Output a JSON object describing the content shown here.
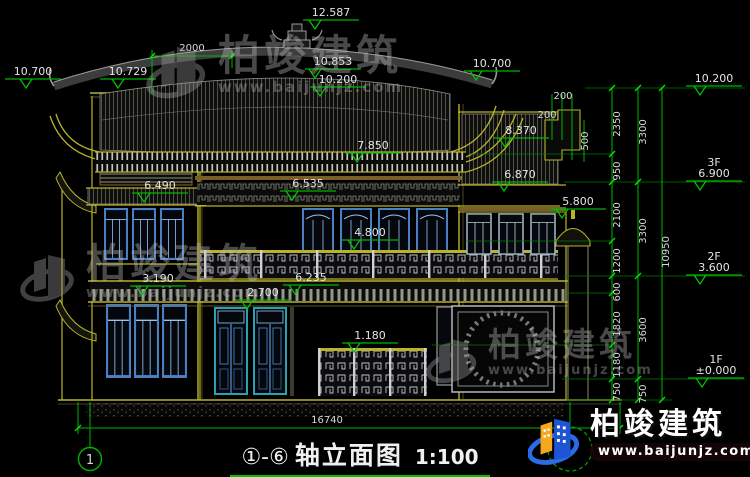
{
  "title": {
    "axes": "①-⑥",
    "name": "轴立面图",
    "scale": "1:100"
  },
  "axis_bubbles": {
    "left": "1"
  },
  "watermark": {
    "brand": "柏竣建筑",
    "url": "www.baijunjz.com"
  },
  "logo": {
    "brand": "柏竣建筑",
    "url": "www.baijunjz.com"
  },
  "colors": {
    "background": "#000000",
    "dim_green": "#00b400",
    "outline_yellow": "#b9b32a",
    "window_blue": "#4a7fc1",
    "text": "#e4e4e4"
  },
  "elevations": {
    "ridge": "12.587",
    "left_eave_outer": "10.700",
    "left_eave_inner": "10.729",
    "roof_upper": "10.853",
    "roof_lower": "10.200",
    "right_eave": "10.700",
    "right_parapet": "10.200",
    "wing_parapet": "8.370",
    "wing_band": "6.870",
    "wing_beam": "5.800",
    "f3_rail": "7.850",
    "f3_beam": "6.535",
    "f2_rail": "4.800",
    "f2_beam": "6.235",
    "door_top": "2.700",
    "f1_rail": "1.180",
    "tower_upper": "6.490",
    "tower_lower": "3.190",
    "floor3_label": "3F",
    "floor3": "6.900",
    "floor2_label": "2F",
    "floor2": "3.600",
    "floor1_label": "1F",
    "floor1": "±0.000"
  },
  "dimensions": {
    "top_span": "2000",
    "total_width": "16740",
    "parapet": [
      "200",
      "200",
      "500"
    ],
    "right_inner": [
      "2350",
      "950",
      "2100",
      "1200",
      "600",
      "1820",
      "1180",
      "750"
    ],
    "right_mid": [
      "3300",
      "3300",
      "3600",
      "750"
    ],
    "right_total": "10950"
  }
}
